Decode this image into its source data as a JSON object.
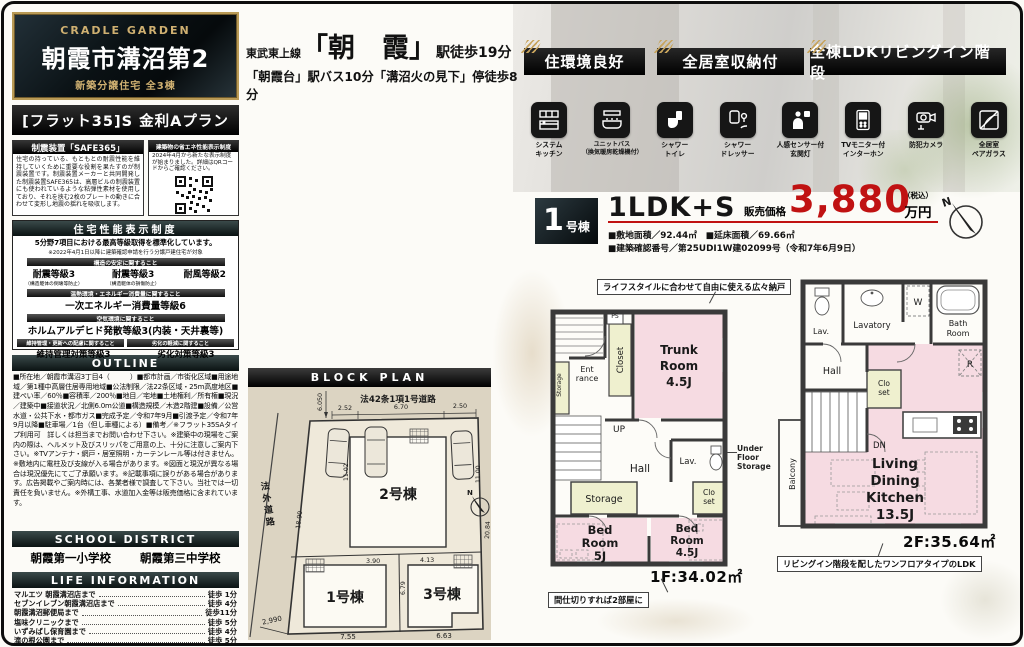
{
  "colors": {
    "price_red": "#c01212",
    "gold": "#c8a45c"
  },
  "left": {
    "plaque": {
      "brand": "CRADLE GARDEN",
      "title": "朝霞市溝沼第2",
      "subtitle": "新築分譲住宅 全3棟"
    },
    "flat35": "[フラット35]S 金利Aプラン",
    "seismic": {
      "header": "制震装置「SAFE365」",
      "body": "住宅の持っている、もともとの耐震性能を維持していくために重要な役割を果たすのが制震装置です。制震装置メーカーと共同開発した制震装置SAFE365は、高層ビルの制震装置にも使われているような粘弾性素材を使用しており、それを挟む2枚のプレートの動きに合わせて変形し地震の揺れを吸収します。"
    },
    "energy": {
      "header": "建築物の省エネ性能表示制度",
      "body": "2024年4月から新たな表示制度が始まりました。詳細はQRコードからご確認ください。"
    },
    "performance": {
      "header": "住宅性能表示制度",
      "lead": "5分野7項目における最高等級取得を標準化しています。",
      "note": "※2022年4月1日以降に建築確認申請を行う分譲戸建住宅が対象",
      "s1": "構造の安定に関すること",
      "g1": "耐震等級3",
      "g1n": "（構造躯体の倒壊等防止）",
      "g2": "耐震等級3",
      "g2n": "（構造躯体の損傷防止）",
      "g3": "耐風等級2",
      "s2": "温熱環境・エネルギー消費量に関すること",
      "g4": "一次エネルギー消費量等級6",
      "s3": "空気環境に関すること",
      "g5": "ホルムアルデヒド発散等級3(内装・天井裏等)",
      "s4": "維持管理・更新への配慮に関すること",
      "s5": "劣化の軽減に関すること",
      "g6": "維持管理対策等級3",
      "g7": "劣化対策等級3"
    },
    "outline": {
      "header": "OUTLINE",
      "body": "■所在地／朝霞市溝沼3丁目4（　　　）■都市計画／市街化区域■用途地域／第1種中高層住居専用地域■公法制限／法22条区域・25m高度地区■建ぺい率／60％■容積率／200％■地目／宅地■土地権利／所有権■現況／建築中■接道状況／北側6.0m公道■構造規模／木造2階建■設備／公営水道・公共下水・都市ガス■完成予定／令和7年9月■引渡予定／令和7年9月以降■駐車場／1台（但し車種による）■備考／※フラット35SAタイプ利用可　詳しくは担当までお問い合わせ下さい。※建築中の現場をご案内の際は、ヘルメット及びスリッパをご用意の上、十分に注意しご案内下さい。※TVアンテナ・網戸・居室照明・カーテンレール等は付きません。※敷地内に電柱及び支線が入る場合があります。※図面と現況が異なる場合は現況優先にてご了承願います。※記載事項に誤りがある場合があります。広告掲載やご案内時には、各業者様で調査して下さい。当社では一切責任を負いません。※外構工事、水道加入金等は販売価格に含まれています。"
    },
    "school": {
      "header": "SCHOOL DISTRICT",
      "elementary": "朝霞第一小学校",
      "junior": "朝霞第三中学校"
    },
    "life": {
      "header": "LIFE INFORMATION",
      "items": [
        {
          "name": "マルエツ 朝霞溝沼店まで",
          "time": "徒歩 1分"
        },
        {
          "name": "セブンイレブン朝霞溝沼店まで",
          "time": "徒歩 4分"
        },
        {
          "name": "朝霞溝沼郵便局まで",
          "time": "徒歩11分"
        },
        {
          "name": "塩味クリニックまで",
          "time": "徒歩 5分"
        },
        {
          "name": "いずみばし保育園まで",
          "time": "徒歩 4分"
        },
        {
          "name": "滝の根公園まで",
          "time": "徒歩 5分"
        }
      ]
    }
  },
  "access": {
    "line": "東武東上線",
    "station": "「朝　霞」",
    "walk": "駅徒歩19分",
    "line2": "「朝霞台」駅バス10分「溝沼火の見下」停徒歩8分"
  },
  "badges": [
    "住環境良好",
    "全居室収納付",
    "全棟LDKリビングイン階段"
  ],
  "amenities": [
    {
      "icon": "system-kitchen-icon",
      "label": "システム\nキッチン"
    },
    {
      "icon": "unit-bath-icon",
      "label": "ユニットバス\n（換気暖房乾燥機付）"
    },
    {
      "icon": "shower-toilet-icon",
      "label": "シャワー\nトイレ"
    },
    {
      "icon": "shower-dresser-icon",
      "label": "シャワー\nドレッサー"
    },
    {
      "icon": "sensor-light-icon",
      "label": "人感センサー付\n玄関灯"
    },
    {
      "icon": "tv-intercom-icon",
      "label": "TVモニター付\nインターホン"
    },
    {
      "icon": "security-camera-icon",
      "label": "防犯カメラ"
    },
    {
      "icon": "pair-glass-icon",
      "label": "全居室\nペアガラス"
    }
  ],
  "unit": {
    "number": "1",
    "suffix": "号棟",
    "plan": "1LDK+S",
    "price_label": "販売価格",
    "price": "3,880",
    "tax": "（税込）",
    "man": "万円",
    "line1": "■敷地面積／92.44㎡　■延床面積／69.66㎡",
    "line2": "■建築確認番号／第25UDI1W建02099号（令和7年6月9日）"
  },
  "blockplan": {
    "header": "BLOCK PLAN",
    "road_top": "法42条1項1号道路",
    "offset": "6.050",
    "d1": "2.52",
    "d2": "6.70",
    "d3": "2.50",
    "side_road": [
      "法",
      "外",
      "道",
      "路"
    ],
    "side_w": "2,990",
    "edge": "18.90",
    "p1": "11.02",
    "p2": "11.00",
    "right": "20.84",
    "w1": "3.90",
    "w2": "4.13",
    "mid": "6.79",
    "b1": "7.55",
    "b2": "6.63",
    "lot1": "1号棟",
    "lot2": "2号棟",
    "lot3": "3号棟",
    "north": "N"
  },
  "fp1": {
    "callout_top": "ライフスタイルに合わせて自由に使える広々納戸",
    "callout_bottom": "間仕切りすれば2部屋に",
    "ps": "PS",
    "closet": "Closet",
    "trunk": [
      "Trunk",
      "Room",
      "4.5J"
    ],
    "storage_left": "Storage",
    "ent": [
      "Ent",
      "rance"
    ],
    "up": "UP",
    "hall": "Hall",
    "lav": "Lav.",
    "storage": "Storage",
    "clo": [
      "Clo",
      "set"
    ],
    "bed1": [
      "Bed",
      "Room",
      "5J"
    ],
    "bed2": [
      "Bed",
      "Room",
      "4.5J"
    ],
    "ufs": "Under\nFloor\nStorage",
    "area": "1F:34.02㎡"
  },
  "fp2": {
    "lav": "Lav.",
    "lavatory": "Lavatory",
    "w": "W",
    "bath": [
      "Bath",
      "Room"
    ],
    "hall": "Hall",
    "clo": [
      "Clo",
      "set"
    ],
    "dn": "DN",
    "r": "R",
    "ldk": [
      "Living",
      "Dining",
      "Kitchen",
      "13.5J"
    ],
    "balcony": "Balcony",
    "area": "2F:35.64㎡",
    "callout": "リビングイン階段を配したワンフロアタイプのLDK"
  },
  "compass_n": "N"
}
